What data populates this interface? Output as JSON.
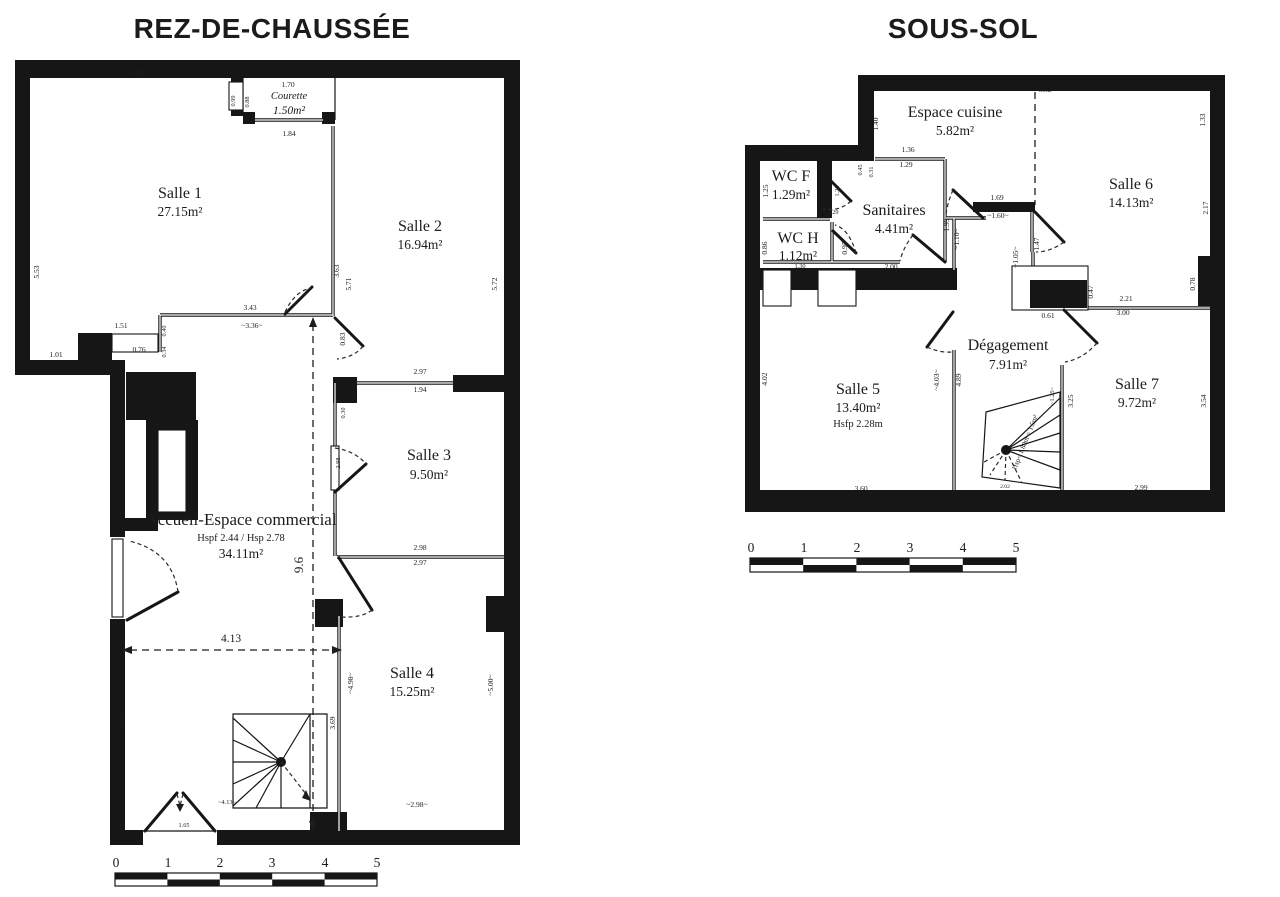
{
  "colors": {
    "ink": "#161616",
    "background": "#ffffff"
  },
  "rdc": {
    "title": "REZ-DE-CHAUSSÉE",
    "rooms": {
      "salle1": {
        "name": "Salle 1",
        "area": "27.15m²"
      },
      "salle2": {
        "name": "Salle 2",
        "area": "16.94m²"
      },
      "courette": {
        "name": "Courette",
        "area": "1.50m²"
      },
      "salle3": {
        "name": "Salle 3",
        "area": "9.50m²"
      },
      "accueil": {
        "name": "Accueil-Espace commercial",
        "heights": "Hspf 2.44 / Hsp 2.78",
        "area": "34.11m²"
      },
      "salle4": {
        "name": "Salle 4",
        "area": "15.25m²"
      }
    },
    "dims": [
      "4.09",
      "1.70",
      "0.99",
      "0.88",
      "1.84",
      "5.53",
      "3.63",
      "5.71",
      "5.72",
      "3.43",
      "~3.36~",
      "0.83",
      "1.51",
      "0.40",
      "0.76",
      "0.34",
      "1.01",
      "0.59",
      "2.97",
      "1.94",
      "0.35",
      "0.30",
      "2.98",
      "2.98",
      "2.97",
      "9.6",
      "4.13",
      "~4.98~",
      "~5.00~",
      "3.77",
      "3.69",
      "~4.13~",
      "~2.98~",
      "1.65"
    ],
    "scale": [
      "0",
      "1",
      "2",
      "3",
      "4",
      "5"
    ]
  },
  "ssol": {
    "title": "SOUS-SOL",
    "rooms": {
      "cuisine": {
        "name": "Espace cuisine",
        "area": "5.82m²"
      },
      "wcf": {
        "name": "WC F",
        "area": "1.29m²"
      },
      "wch": {
        "name": "WC H",
        "area": "1.12m²"
      },
      "sanitaires": {
        "name": "Sanitaires",
        "area": "4.41m²"
      },
      "salle6": {
        "name": "Salle 6",
        "area": "14.13m²"
      },
      "salle5": {
        "name": "Salle 5",
        "area": "13.40m²",
        "height_note": "Hsfp 2.28m"
      },
      "degagement": {
        "name": "Dégagement",
        "area": "7.91m²"
      },
      "salle7": {
        "name": "Salle 7",
        "area": "9.72m²"
      }
    },
    "stair_note": "Hsp< 1.80m = 1.5m²",
    "dims": [
      "6.52",
      "1.40",
      "1.33",
      "1.03",
      "0.92",
      "0.45",
      "0.31",
      "1.36",
      "1.29",
      "1.25",
      "1.20",
      "0.29",
      "0.86",
      "0.95",
      "1.30",
      "2.00",
      "1.99",
      "1.69",
      "~1.60~",
      "~1.10~",
      "1.47",
      "~1.05~",
      "0.47",
      "0.61",
      "2.21",
      "3.00",
      "2.17",
      "0.30",
      "0.78",
      "4.02",
      "3.60",
      "~4.03~",
      "4.89",
      "3.25",
      "~1.25~",
      "2.02",
      "2.99",
      "3.54"
    ],
    "scale": [
      "0",
      "1",
      "2",
      "3",
      "4",
      "5"
    ]
  }
}
